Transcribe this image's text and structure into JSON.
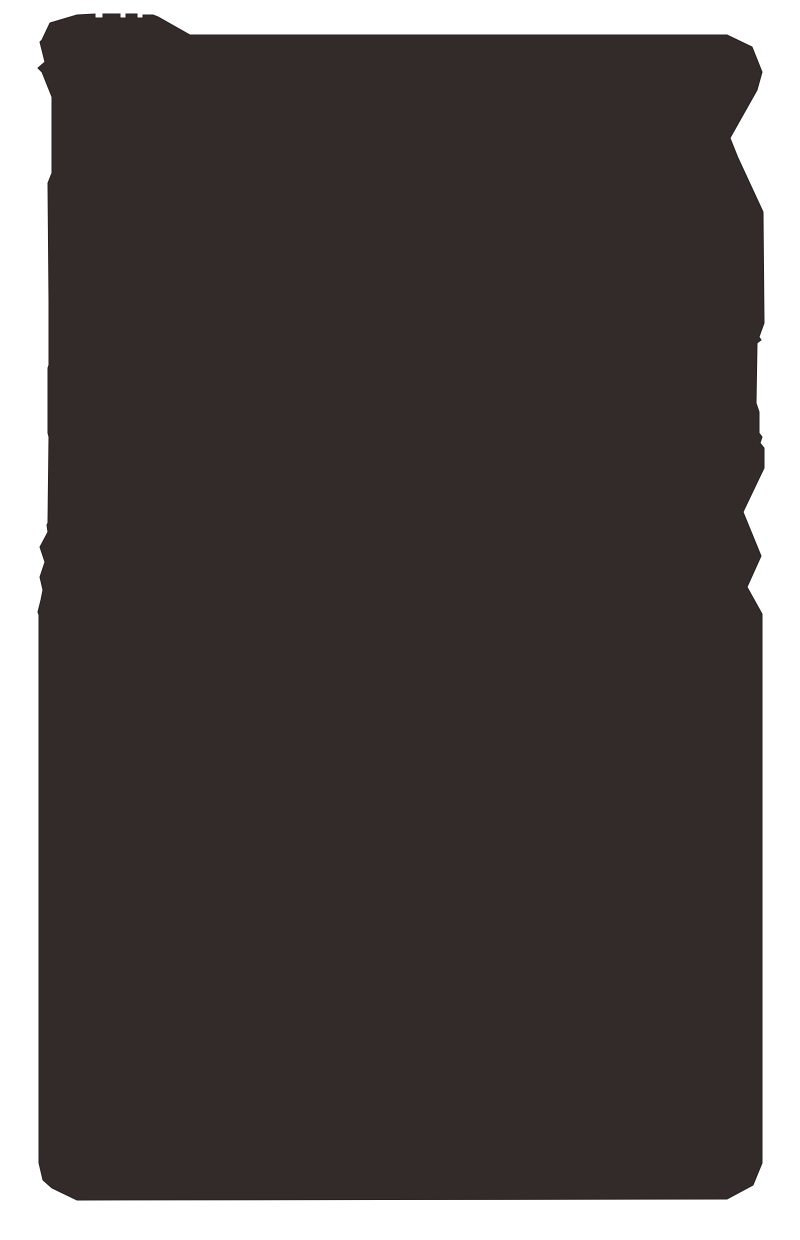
{
  "canvas": {
    "width": 800,
    "height": 1240,
    "background": "#FFFFFF"
  },
  "silhouette": {
    "fill": "#332B29",
    "stroke": "#24201F",
    "stroke_width": "1",
    "points": "50,23 77,15 95,14 95,18 103,18 103,14 120,14 120,18 126,18 126,14 137,14 137,18 143,18 143,15 153,15 158,17 190,35 727,35 752,47 762,72 757,90 730,138 738,158 763,212 764,323 759,337 761,340 757,343 756,403 759,412 759,433 762,437 760,443 764,448 764,468 743,512 761,556 747,587 762,614 762,1163 753,1185 727,1199 77,1200 52,1188 43,1180 39,1163 39,615 38,612 41,600 43,590 40,577 45,562 40,547 48,532 47,525 48,523 49,437 48,433 48,368 49,365 49,300 48,183 52,173 52,97 42,72 38,68 45,62 40,42 42,40"
  }
}
